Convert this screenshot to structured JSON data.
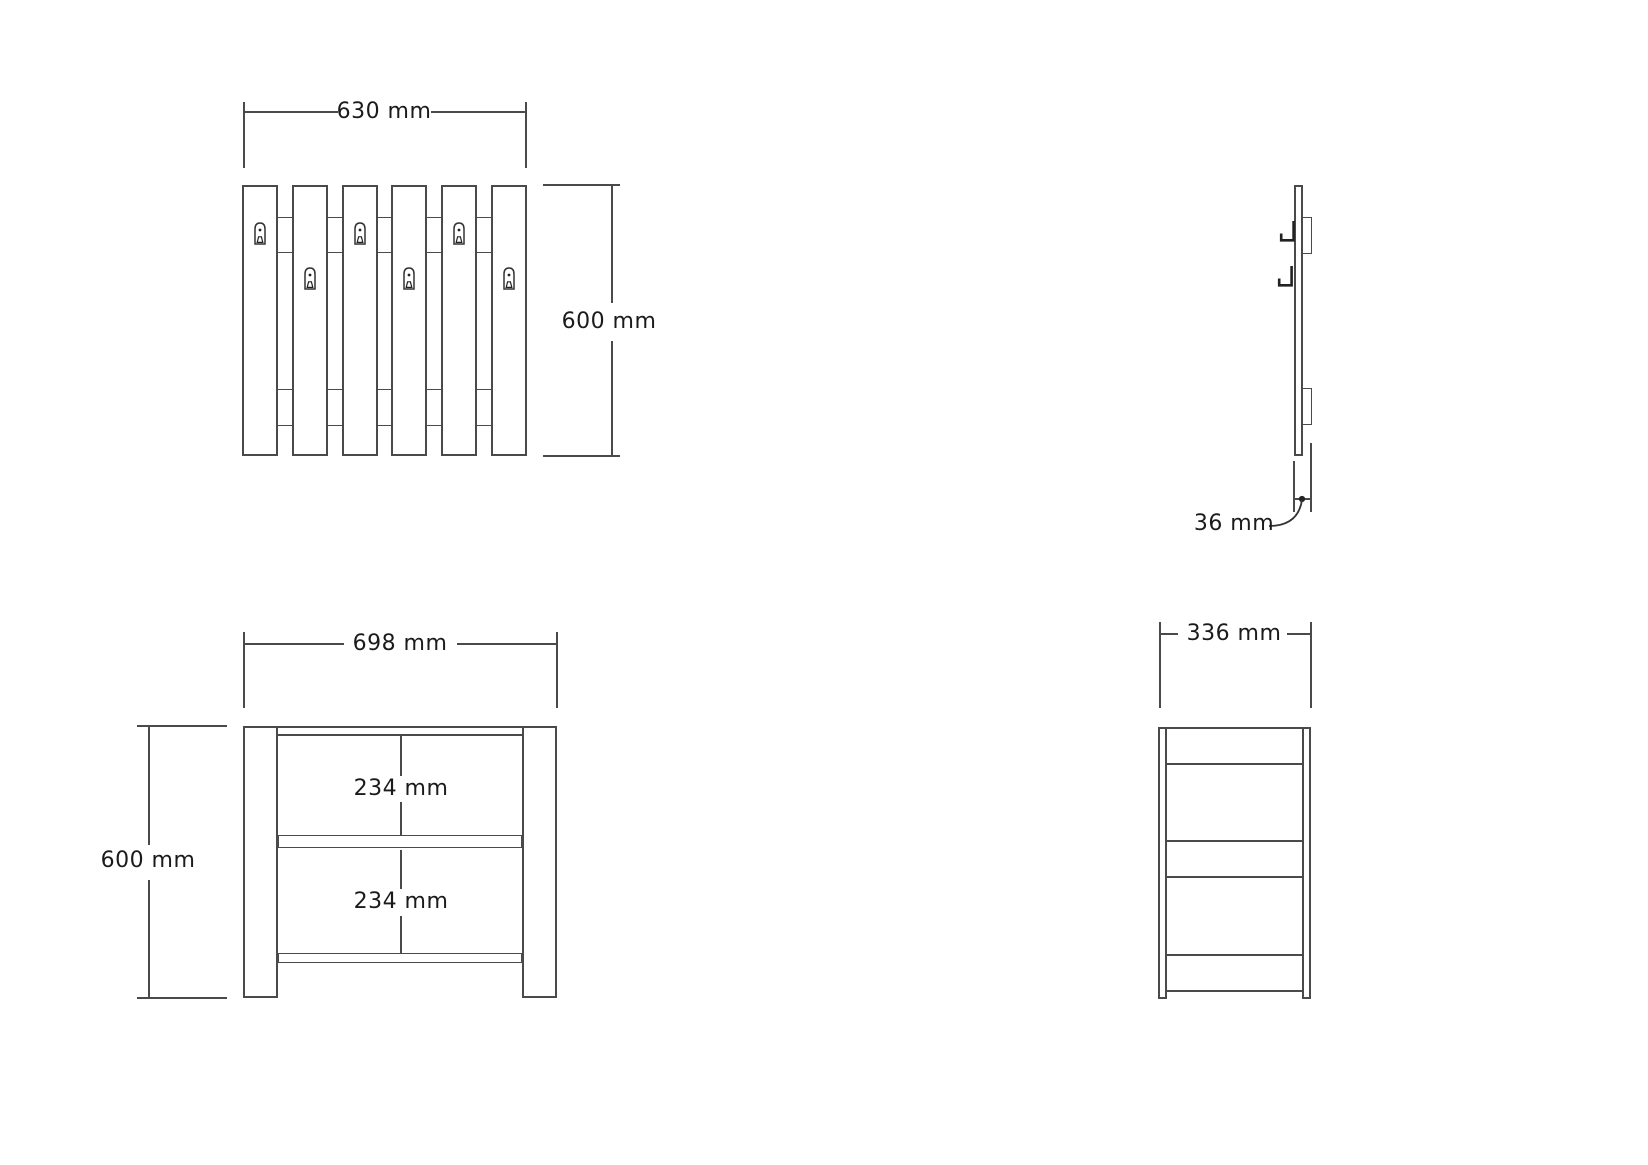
{
  "views": {
    "panel_front": {
      "width_label": "630 mm",
      "height_label": "600 mm",
      "slat_count": 6,
      "keyhole_count": 6,
      "icons": [
        "keyhole-hanger-icon"
      ]
    },
    "panel_side": {
      "thickness_label": "36 mm"
    },
    "bench_front": {
      "width_label": "698 mm",
      "height_label": "600 mm",
      "upper_gap_label": "234 mm",
      "lower_gap_label": "234 mm"
    },
    "bench_side": {
      "depth_label": "336 mm"
    }
  },
  "colors": {
    "line": "#4a4a4a",
    "text": "#1b1b1b",
    "background": "#ffffff"
  }
}
